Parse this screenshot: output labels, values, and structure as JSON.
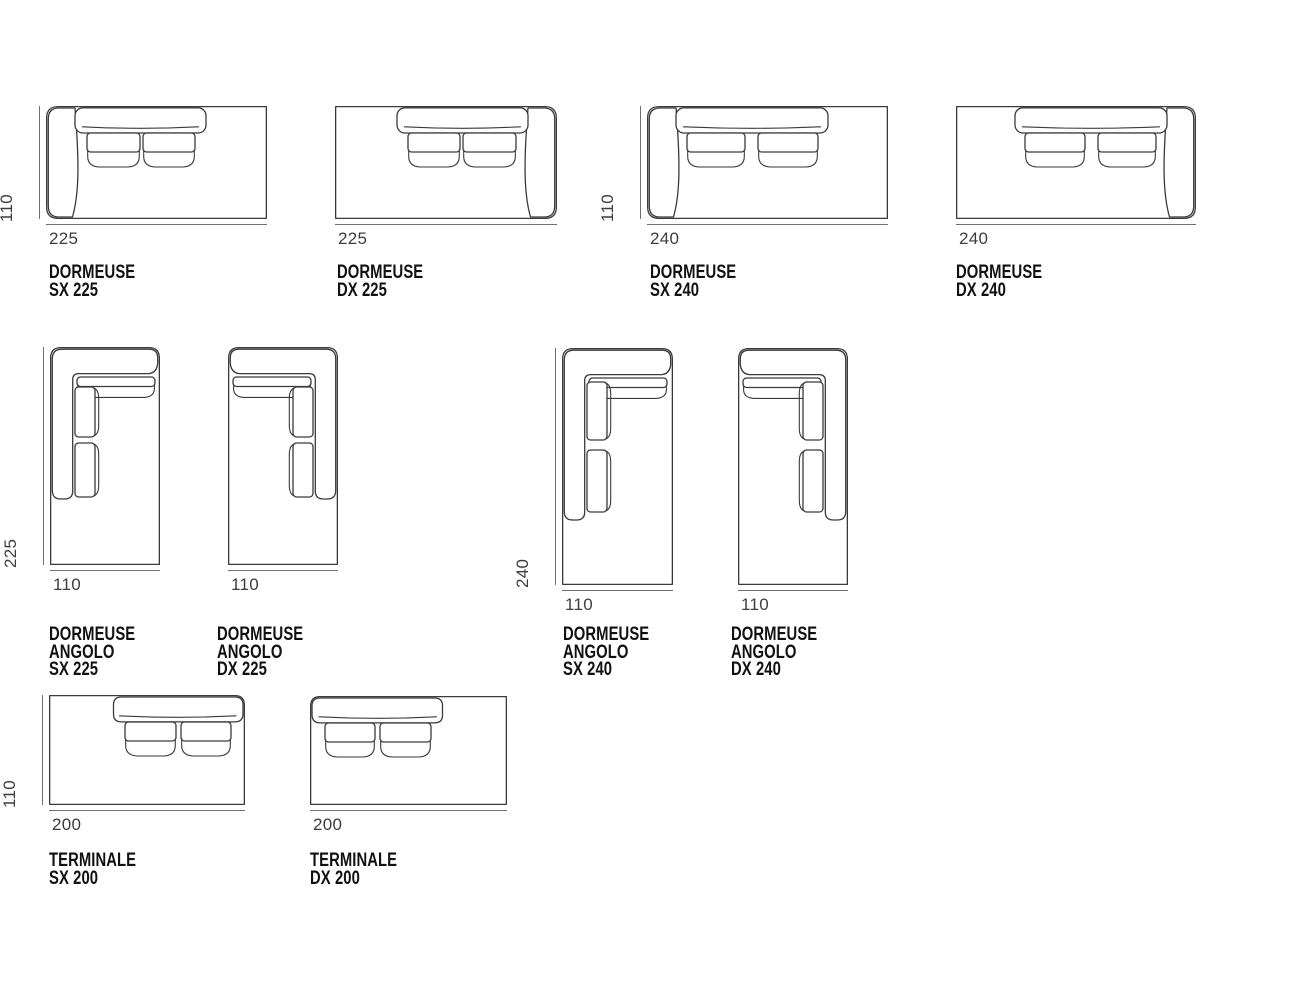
{
  "page": {
    "background_color": "#ffffff",
    "drawing_line_color": "#3a3a3a",
    "dimension_line_color": "#6f6f6f",
    "dimension_text_color": "#3d3d3d",
    "label_text_color": "#111111",
    "description": "Sofa modules top-view dimension drawings"
  },
  "modules": [
    {
      "id": "dormeuse-sx-225",
      "label": "DORMEUSE SX 225",
      "bottom_dim": "225",
      "side_dim": "110",
      "type": "dormeuse",
      "side": "SX"
    },
    {
      "id": "dormeuse-dx-225",
      "label": "DORMEUSE DX 225",
      "bottom_dim": "225",
      "side_dim": null,
      "type": "dormeuse",
      "side": "DX"
    },
    {
      "id": "dormeuse-sx-240",
      "label": "DORMEUSE SX 240",
      "bottom_dim": "240",
      "side_dim": "110",
      "type": "dormeuse",
      "side": "SX"
    },
    {
      "id": "dormeuse-dx-240",
      "label": "DORMEUSE DX 240",
      "bottom_dim": "240",
      "side_dim": null,
      "type": "dormeuse",
      "side": "DX"
    },
    {
      "id": "dormeuse-angolo-sx-225",
      "label": "DORMEUSE ANGOLO\nSX 225",
      "bottom_dim": "110",
      "side_dim": "225",
      "type": "dormeuse-angolo",
      "side": "SX"
    },
    {
      "id": "dormeuse-angolo-dx-225",
      "label": "DORMEUSE ANGOLO\nDX 225",
      "bottom_dim": "110",
      "side_dim": null,
      "type": "dormeuse-angolo",
      "side": "DX"
    },
    {
      "id": "dormeuse-angolo-sx-240",
      "label": "DORMEUSE ANGOLO\nSX 240",
      "bottom_dim": "110",
      "side_dim": "240",
      "type": "dormeuse-angolo",
      "side": "SX"
    },
    {
      "id": "dormeuse-angolo-dx-240",
      "label": "DORMEUSE ANGOLO\nDX 240",
      "bottom_dim": "110",
      "side_dim": null,
      "type": "dormeuse-angolo",
      "side": "DX"
    },
    {
      "id": "terminale-sx-200",
      "label": "TERMINALE SX 200",
      "bottom_dim": "200",
      "side_dim": "110",
      "type": "terminale",
      "side": "SX"
    },
    {
      "id": "terminale-dx-200",
      "label": "TERMINALE DX 200",
      "bottom_dim": "200",
      "side_dim": null,
      "type": "terminale",
      "side": "DX"
    }
  ]
}
